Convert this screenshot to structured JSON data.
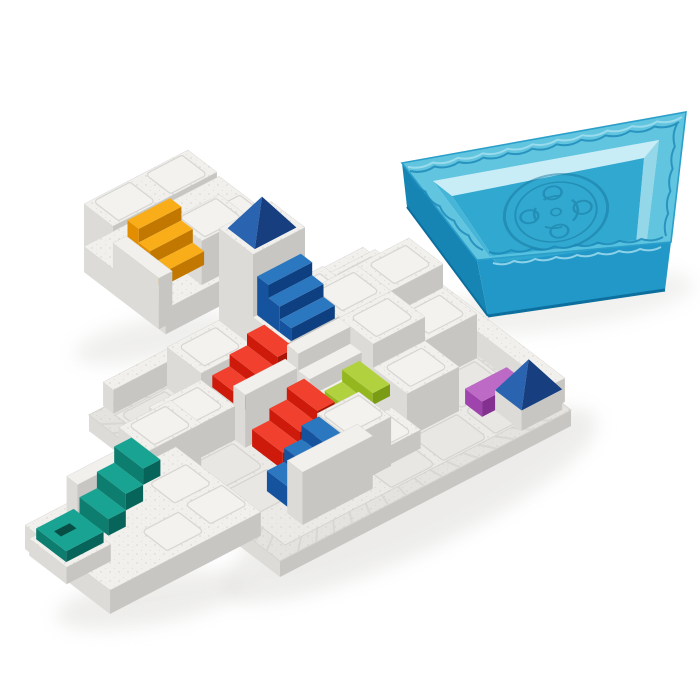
{
  "colors": {
    "background": "#ffffff",
    "plastic_white_top": "#f1f0ed",
    "plastic_white_left": "#dcdbd7",
    "plastic_white_right": "#c7c6c2",
    "plastic_deck": "#eceae6",
    "plastic_rim": "#e4e3df",
    "tile_fill": "#e9e7e3",
    "tile_stroke": "#d5d4d0",
    "stud_fill": "#f3f2ef",
    "stud_stroke": "#d7d6d2",
    "speckle": "#b7b6b2",
    "shadow": "#dcdbd7",
    "red_top": "#f2402e",
    "red_front": "#cd1a0a",
    "red_side": "#a81407",
    "orange_top": "#f9ae19",
    "orange_front": "#e38d00",
    "orange_side": "#c17700",
    "teal_top": "#19a392",
    "teal_front": "#0d7d6f",
    "teal_side": "#07645a",
    "teal_slot": "#074f45",
    "lime_top": "#b1d13f",
    "lime_front": "#94b71f",
    "lime_side": "#7a9c15",
    "blue_top": "#2b77c0",
    "blue_front": "#16539e",
    "blue_side": "#0e3f80",
    "purple_top": "#bd6ac7",
    "purple_front": "#a044ad",
    "purple_side": "#833091",
    "pyramid_light": "#2a64b1",
    "pyramid_dark": "#173f7f",
    "tray_rim": "#59c2de",
    "tray_rim_hi": "#a7e0ef",
    "tray_floor": "#31a8cf",
    "tray_wall_backleft": "#c9edf6",
    "tray_wall_backright": "#93d7e9",
    "tray_wall_innerfront": "#3fb0d4",
    "tray_wall_innerleft": "#45b5d8",
    "tray_front": "#1a95c6",
    "tray_side": "#0f81b2",
    "tray_edge": "#0c6f9e",
    "tray_wave": "#1c87b7",
    "tray_logo": "#16779f",
    "tray_outline": "#2b9fca"
  },
  "scene": {
    "canvas": {
      "w": 700,
      "h": 700
    },
    "iso": {
      "ux": 52,
      "uy": -27,
      "vx": 34,
      "vy": 26,
      "hz": 34
    },
    "shadows": [
      {
        "cx": 410,
        "cy": 505,
        "rx": 205,
        "ry": 48,
        "rot": -25,
        "op": 0.5
      },
      {
        "cx": 210,
        "cy": 495,
        "rx": 90,
        "ry": 26,
        "rot": 35,
        "op": 0.3
      },
      {
        "cx": 155,
        "cy": 338,
        "rx": 82,
        "ry": 20,
        "rot": -12,
        "op": 0.45
      },
      {
        "cx": 150,
        "cy": 600,
        "rx": 95,
        "ry": 24,
        "rot": -10,
        "op": 0.5
      },
      {
        "cx": 560,
        "cy": 303,
        "rx": 135,
        "ry": 26,
        "rot": -8,
        "op": 0.4
      }
    ],
    "board": {
      "name": "game-board",
      "origin": [
        115,
        415
      ],
      "deck": [
        [
          115,
          415
        ],
        [
          375,
          280
        ],
        [
          545,
          410
        ],
        [
          285,
          545
        ]
      ],
      "outer": [
        [
          89,
          415
        ],
        [
          380,
          264
        ],
        [
          571,
          410
        ],
        [
          280,
          561
        ]
      ],
      "wall_drop": 16,
      "tiles": [
        [
          0,
          0
        ],
        [
          0,
          2
        ],
        [
          0,
          3
        ],
        [
          2,
          4
        ],
        [
          3,
          4
        ],
        [
          4,
          4
        ],
        [
          4,
          3
        ]
      ],
      "items": [
        {
          "t": "cube",
          "n": "rim-wall-back-left",
          "a": 0,
          "b": -0.35,
          "w": 5,
          "d": 0.3,
          "h": 0.7,
          "k": -99
        },
        {
          "t": "cube",
          "n": "rim-wall-back-right",
          "a": 5.05,
          "b": 0,
          "w": 0.3,
          "d": 5.05,
          "h": 0.7,
          "k": -98
        },
        {
          "t": "cube",
          "n": "white-block",
          "a": 1,
          "b": 0,
          "h": 1.2,
          "st": [
            [
              1.5,
              0.5
            ]
          ]
        },
        {
          "t": "cube",
          "n": "tower-block",
          "a": 2,
          "b": 0,
          "h": 3.9
        },
        {
          "t": "pyr",
          "n": "blue-pyramid-tower",
          "a": 2.1,
          "b": 0.1,
          "s": 0.8,
          "z": 3.9
        },
        {
          "t": "cube",
          "n": "white-block",
          "a": 3,
          "b": 0,
          "h": 1.2,
          "st": [
            [
              3.5,
              0.5
            ]
          ]
        },
        {
          "t": "cube",
          "n": "white-block",
          "a": 4,
          "b": 0,
          "h": 0.9,
          "st": [
            [
              4.5,
              0.5
            ]
          ]
        },
        {
          "t": "cube",
          "n": "stairs-support-block",
          "a": 2,
          "b": 1,
          "h": 2.05
        },
        {
          "t": "stairsV",
          "n": "blue-staircase-tower",
          "color": "blue",
          "a": 2.08,
          "b": 1,
          "w": 0.84,
          "z": 2.05,
          "sh": 0.38
        },
        {
          "t": "stairsV",
          "n": "white-staircase",
          "color": "white",
          "a": 2,
          "b": 2,
          "w": 1,
          "z": 0.5,
          "sh": 0.5,
          "deep": true
        },
        {
          "t": "cube",
          "n": "white-block",
          "a": 0,
          "b": 1,
          "h": 1.0,
          "st": [
            [
              0.5,
              1.5
            ]
          ]
        },
        {
          "t": "cube",
          "n": "stairs-platform",
          "a": 1.3,
          "b": 0.95,
          "w": 1,
          "d": 0.9,
          "h": 0.55,
          "k": -0.5
        },
        {
          "t": "stairsU",
          "n": "red-staircase-upper",
          "color": "red",
          "a": 1.25,
          "b": 0.95,
          "d": 0.9,
          "z": 0.55,
          "sh": 0.35,
          "floor": 0.55
        },
        {
          "t": "cube",
          "n": "white-wall",
          "a": 1.0,
          "b": 1.95,
          "w": 1,
          "d": 0.35,
          "h": 1.55
        },
        {
          "t": "stairsU",
          "n": "red-staircase-lower",
          "color": "red",
          "a": 1.1,
          "b": 2.35,
          "d": 0.9,
          "z": 0.15,
          "sh": 0.35,
          "floor": 0
        },
        {
          "t": "cube",
          "n": "white-block",
          "a": 3,
          "b": 1,
          "h": 2.0,
          "st": [
            [
              3.5,
              1.5
            ]
          ]
        },
        {
          "t": "cube",
          "n": "white-block",
          "a": 4,
          "b": 1,
          "h": 2.0,
          "st": [
            [
              4.5,
              1.5
            ]
          ]
        },
        {
          "t": "cube",
          "n": "white-block",
          "a": 3,
          "b": 2,
          "h": 2.0,
          "st": [
            [
              3.5,
              2.5
            ]
          ]
        },
        {
          "t": "cube",
          "n": "white-block",
          "a": 4,
          "b": 2,
          "h": 1.3,
          "st": [
            [
              4.5,
              2.5
            ]
          ]
        },
        {
          "t": "stairsU",
          "n": "green-staircase",
          "color": "lime",
          "a": 2.0,
          "b": 2.6,
          "d": 0.9,
          "z": 0.15,
          "sh": 0.35,
          "floor": 0
        },
        {
          "t": "cube",
          "n": "white-block",
          "a": 3,
          "b": 3,
          "h": 1.3,
          "st": [
            [
              3.5,
              3.5
            ]
          ]
        },
        {
          "t": "cube",
          "n": "white-block",
          "a": 2,
          "b": 3.55,
          "w": 1,
          "d": 0.85,
          "h": 0.55,
          "st": [
            [
              2.5,
              3.97
            ]
          ]
        },
        {
          "t": "cube",
          "n": "purple-block",
          "color": "purple",
          "a": 4.15,
          "b": 3.95,
          "w": 0.8,
          "d": 0.5,
          "h": 0.45,
          "zb": 0.05
        },
        {
          "t": "cube",
          "n": "pyramid-base-block",
          "a": 4.42,
          "b": 4.42,
          "w": 0.78,
          "d": 0.78,
          "h": 0.6
        },
        {
          "t": "pyr",
          "n": "blue-pyramid-corner",
          "a": 4.42,
          "b": 4.42,
          "s": 0.78,
          "z": 0.6
        },
        {
          "t": "cube",
          "n": "white-block",
          "a": 1.6,
          "b": 3.5,
          "w": 0.8,
          "d": 0.95,
          "h": 1.45,
          "st": [
            [
              2.0,
              3.95
            ]
          ]
        },
        {
          "t": "stairsU",
          "n": "blue-staircase-front",
          "color": "blue",
          "a": 0.6,
          "b": 3.55,
          "d": 0.9,
          "z": 0.2,
          "sh": 0.4,
          "floor": 0
        },
        {
          "t": "cube",
          "n": "front-wall",
          "a": 0.5,
          "b": 4.3,
          "w": 1.35,
          "d": 0.45,
          "h": 1.55
        }
      ]
    },
    "piece1": {
      "name": "puzzle-piece-orange-stairs",
      "origin": [
        84,
        272
      ],
      "items": [
        {
          "t": "cube",
          "n": "block-back",
          "a": 0,
          "b": 0,
          "w": 2,
          "d": 0.85,
          "h": 2.0,
          "st": [
            [
              0.5,
              0.42
            ],
            [
              1.5,
              0.42
            ]
          ],
          "k": -10
        },
        {
          "t": "cube",
          "n": "block-base",
          "a": 0,
          "b": 0,
          "w": 2.6,
          "d": 2.4,
          "h": 0.75,
          "k": -9,
          "st": [
            [
              1.55,
              1.05
            ],
            [
              2.2,
              1.05
            ],
            [
              1.75,
              1.85
            ],
            [
              2.35,
              1.85
            ]
          ]
        },
        {
          "t": "cube",
          "n": "block-mid",
          "a": 1.15,
          "b": 0.85,
          "w": 0.9,
          "d": 0.85,
          "h": 1.3,
          "st": [
            [
              1.6,
              1.27
            ]
          ]
        },
        {
          "t": "stairsV",
          "n": "orange-staircase",
          "color": "orange",
          "a": 0.28,
          "b": 0.85,
          "w": 0.82,
          "z": 0.75,
          "sh": 0.4
        },
        {
          "t": "cube",
          "n": "block-wall",
          "a": 0,
          "b": 0.85,
          "w": 0.26,
          "d": 1.35,
          "h": 1.5
        }
      ]
    },
    "piece2": {
      "name": "puzzle-piece-teal-stairs",
      "origin": [
        70,
        530
      ],
      "items": [
        {
          "t": "cube",
          "n": "block-back",
          "a": 1,
          "b": -0.1,
          "w": 1,
          "d": 0.9,
          "h": 2.15,
          "st": [
            [
              1.5,
              0.35
            ]
          ],
          "k": -10
        },
        {
          "t": "cube",
          "n": "block-base",
          "a": -0.8,
          "b": -0.1,
          "w": 2.9,
          "d": 2.5,
          "h": 0.7,
          "k": -9,
          "st": [
            [
              1.6,
              0.8
            ],
            [
              1.7,
              1.7
            ],
            [
              0.8,
              1.8
            ]
          ]
        },
        {
          "t": "cube",
          "n": "block-wall-back",
          "a": 0,
          "b": -0.1,
          "w": 1,
          "d": 0.32,
          "h": 1.5,
          "k": -8
        },
        {
          "t": "stairsU",
          "n": "teal-staircase",
          "color": "teal",
          "a": 0,
          "b": 0.28,
          "d": 0.85,
          "z": 0.7,
          "sh": 0.48,
          "floor": 0.7
        },
        {
          "t": "cube",
          "n": "ledge",
          "a": -0.85,
          "b": 0.1,
          "w": 0.85,
          "d": 1.1,
          "h": 0.5,
          "k": 0.9
        },
        {
          "t": "cube",
          "n": "teal-tile",
          "color": "teal",
          "a": -0.78,
          "b": 0.2,
          "w": 0.72,
          "d": 0.88,
          "h": 0.32,
          "zb": 0.5,
          "k": 1.0,
          "slot": [
            -0.62,
            0.48,
            0.3,
            0.2
          ]
        }
      ]
    },
    "tray": {
      "name": "storage-tray-lid",
      "outer": [
        [
          402,
          163
        ],
        [
          686,
          112
        ],
        [
          671,
          242
        ],
        [
          477,
          260
        ]
      ],
      "rim_inner": [
        [
          433,
          181
        ],
        [
          659,
          140
        ],
        [
          647,
          239
        ],
        [
          489,
          256
        ]
      ],
      "floor": [
        [
          452,
          196
        ],
        [
          644,
          158
        ],
        [
          636,
          244
        ],
        [
          497,
          263
        ]
      ],
      "left_bottom": [
        407,
        207
      ],
      "front_bottom": [
        [
          488,
          316
        ],
        [
          665,
          290
        ]
      ],
      "logo": {
        "cx": 556,
        "cy": 212,
        "rot": -10,
        "sy": 0.72
      },
      "waves": [
        {
          "f": [
            410,
            171
          ],
          "t": [
            679,
            122
          ],
          "n": 11,
          "amp": 5.5,
          "hi": false
        },
        {
          "f": [
            408,
            167
          ],
          "t": [
            682,
            117
          ],
          "n": 11,
          "amp": 5,
          "hi": true
        },
        {
          "f": [
            489,
            252
          ],
          "t": [
            663,
            237
          ],
          "n": 8,
          "amp": 5,
          "hi": false
        },
        {
          "f": [
            493,
            263
          ],
          "t": [
            661,
            247
          ],
          "n": 8,
          "amp": 4.5,
          "hi": true
        },
        {
          "f": [
            411,
            177
          ],
          "t": [
            483,
            250
          ],
          "n": 5,
          "amp": 4.5,
          "hi": false
        },
        {
          "f": [
            677,
            124
          ],
          "t": [
            666,
            236
          ],
          "n": 5,
          "amp": 4.5,
          "hi": false
        }
      ]
    }
  }
}
